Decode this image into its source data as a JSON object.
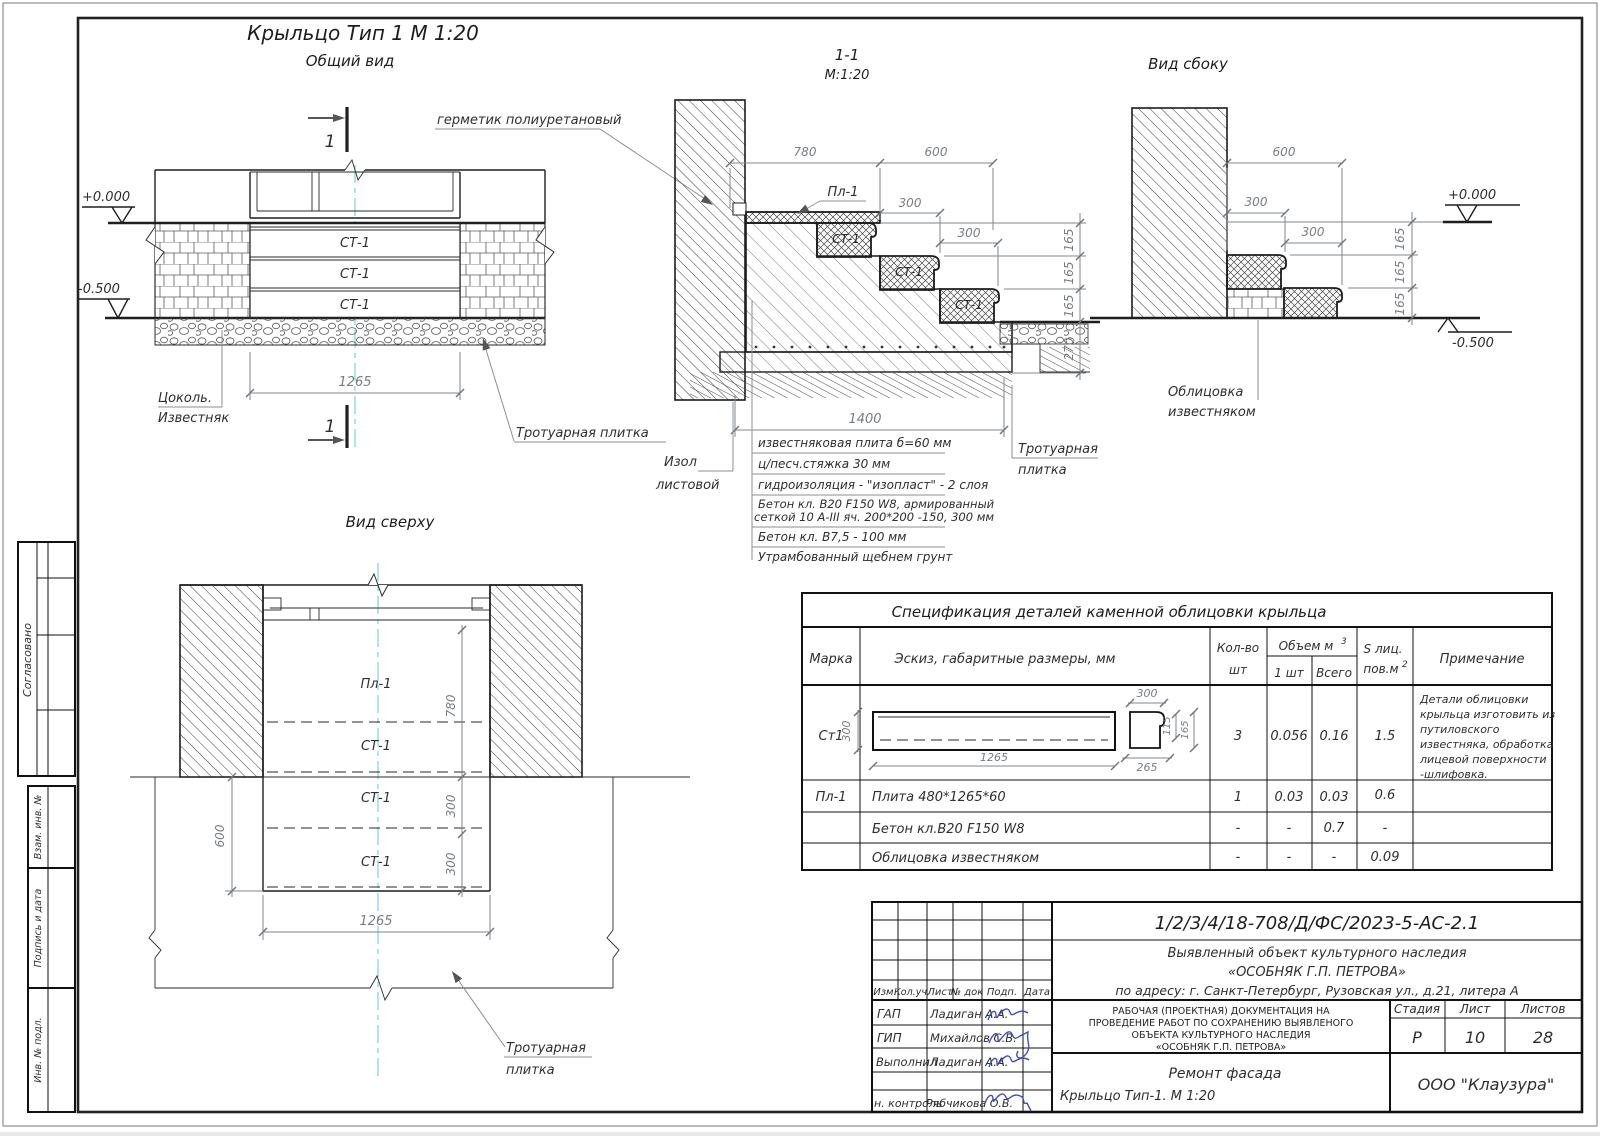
{
  "colors": {
    "centerline": "#74d6da",
    "signature": "#4050c0",
    "line": "#1f1f1f",
    "dimension": "#787d82"
  },
  "common": {
    "st1": "СТ-1",
    "pl1": "Пл-1",
    "one": "1",
    "d165": "165",
    "d270": "270",
    "d300": "300",
    "d600": "600",
    "d780": "780",
    "d1265": "1265",
    "d1400": "1400",
    "d115": "115",
    "d265": "265",
    "elev_zero": "+0.000",
    "elev_minus": "-0.500"
  },
  "general_view": {
    "title": "Крыльцо Тип 1  М 1:20",
    "subtitle": "Общий вид",
    "label_tsokol_1": "Цоколь.",
    "label_tsokol_2": "Известняк",
    "label_plitka": "Тротуарная плитка",
    "label_germetik": "герметик полиуретановый"
  },
  "section": {
    "title": "1-1",
    "scale": "М:1:20",
    "label_izol_1": "Изол",
    "label_izol_2": "листовой",
    "label_plitka_1": "Тротуарная",
    "label_plitka_2": "плитка",
    "notes": [
      "известняковая плита б=60 мм",
      "ц/песч.стяжка 30 мм",
      "гидроизоляция - \"изопласт\" - 2 слоя",
      "Бетон кл. В20 F150 W8, армированный",
      "сеткой 10 А-III яч. 200*200 -150, 300 мм",
      "Бетон кл. В7,5 - 100 мм",
      "Утрамбованный щебнем грунт"
    ]
  },
  "side_view": {
    "title": "Вид сбоку",
    "label_oblitsovka_1": "Облицовка",
    "label_oblitsovka_2": "известняком"
  },
  "top_view": {
    "title": "Вид сверху",
    "label_plitka_1": "Тротуарная",
    "label_plitka_2": "плитка"
  },
  "spec_table": {
    "title": "Спецификация деталей каменной облицовки крыльца",
    "col_marka": "Марка",
    "col_sketch": "Эскиз, габаритные размеры, мм",
    "col_qty_1": "Кол-во",
    "col_qty_2": "шт",
    "col_volume": "Объем м",
    "col_volume_sup": "3",
    "col_one_pc": "1 шт",
    "col_total": "Всего",
    "col_s_1": "S лиц.",
    "col_s_2": "пов.м",
    "col_s_sup": "2",
    "col_note": "Примечание",
    "row_st1": {
      "marka": "Ст1",
      "qty": "3",
      "vol_one": "0.056",
      "vol_total": "0.16",
      "s": "1.5"
    },
    "st1_note": [
      "Детали облицовки",
      "крыльца изготовить из",
      "путиловского",
      "известняка, обработка",
      "лицевой поверхности",
      "-шлифовка."
    ],
    "row_pl1": {
      "marka": "Пл-1",
      "desc": "Плита 480*1265*60",
      "qty": "1",
      "vol_one": "0.03",
      "vol_total": "0.03",
      "s": "0.6"
    },
    "row_concrete": {
      "desc": "Бетон кл.В20 F150 W8",
      "qty": "-",
      "vol_one": "-",
      "vol_total": "0.7",
      "s": "-"
    },
    "row_facing": {
      "desc": "Облицовка  известняком",
      "qty": "-",
      "vol_one": "-",
      "vol_total": "-",
      "s": "0.09"
    }
  },
  "title_block": {
    "doc_number": "1/2/3/4/18-708/Д/ФС/2023-5-АС-2.1",
    "object_line_1": "Выявленный объект культурного наследия",
    "object_line_2": "«ОСОБНЯК Г.П. ПЕТРОВА»",
    "object_line_3": "по адресу: г. Санкт-Петербург, Рузовская ул., д.21, литера А",
    "col_izm": "Изм.",
    "col_koluch": "Кол.уч.",
    "col_list": "Лист",
    "col_ndok": "№ док",
    "col_podp": "Подп.",
    "col_data": "Дата",
    "role_1": "ГАП",
    "role_2": "ГИП",
    "role_3": "Выполнил",
    "role_4": "н. контроль",
    "name_1": "Ладиган А.А.",
    "name_2": "Михайлов С.В.",
    "name_3": "Ладиган А.А.",
    "name_4": "Рябчикова О.В.",
    "desc_line_1": "РАБОЧАЯ (ПРОЕКТНАЯ) ДОКУМЕНТАЦИЯ НА",
    "desc_line_2": "ПРОВЕДЕНИЕ РАБОТ ПО СОХРАНЕНИЮ ВЫЯВЛЕНОГО",
    "desc_line_3": "ОБЪЕКТА КУЛЬТУРНОГО НАСЛЕДИЯ",
    "desc_line_4": "«ОСОБНЯК Г.П. ПЕТРОВА»",
    "stage_label": "Стадия",
    "sheet_label": "Лист",
    "sheets_label": "Листов",
    "stage_value": "Р",
    "sheet_value": "10",
    "sheets_value": "28",
    "subject_line_1": "Ремонт фасада",
    "subject_line_2": "Крыльцо Тип-1.  М 1:20",
    "company": "ООО \"Клаузура\""
  },
  "left_stamp": {
    "soglasovano": "Согласовано",
    "vzam": "Взам. инв. №",
    "podpis": "Подпись и дата",
    "inv": "Инв. № подл."
  }
}
